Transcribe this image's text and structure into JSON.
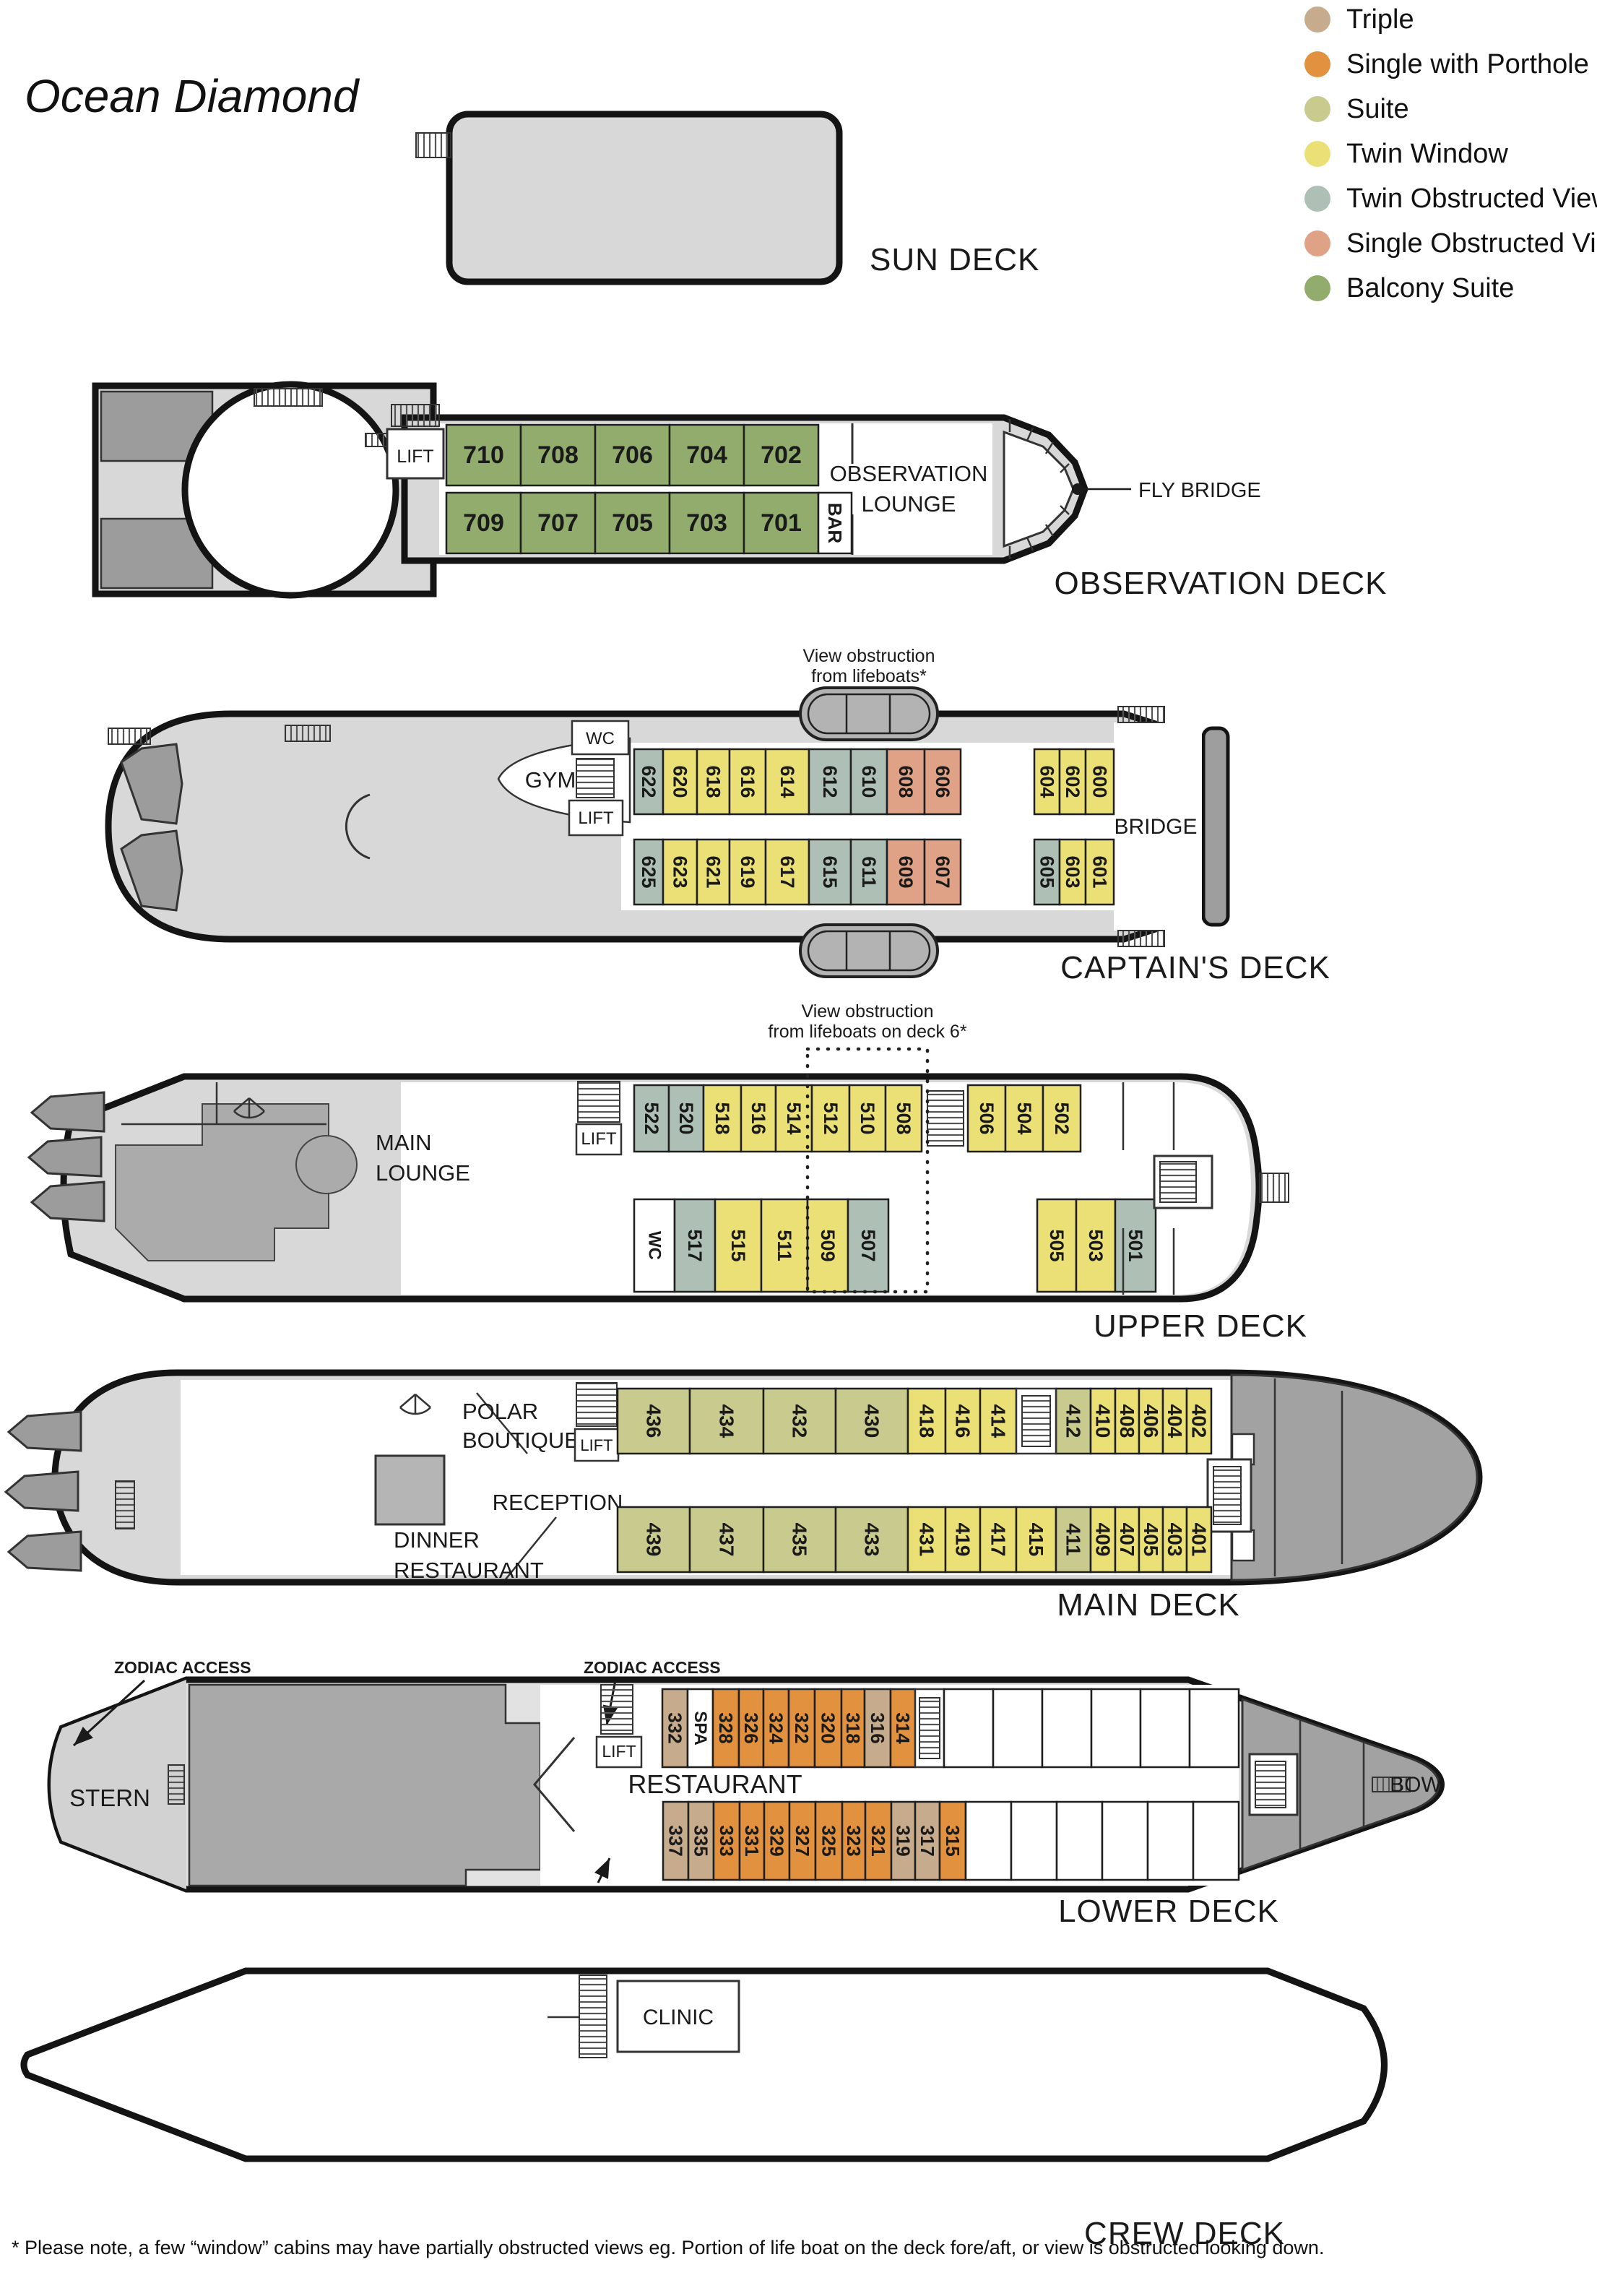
{
  "title": "Ocean Diamond",
  "colors": {
    "triple": "#c6ab8c",
    "single_porthole": "#e2913e",
    "suite": "#c9cb8e",
    "twin_window": "#ebe076",
    "twin_obstructed": "#aec0b6",
    "single_obstructed": "#dfa287",
    "balcony_suite": "#92ac6d",
    "room": "#ffffff"
  },
  "legend": [
    {
      "label": "Triple",
      "type": "triple"
    },
    {
      "label": "Single with Porthole",
      "type": "single_porthole"
    },
    {
      "label": "Suite",
      "type": "suite"
    },
    {
      "label": "Twin Window",
      "type": "twin_window"
    },
    {
      "label": "Twin Obstructed View",
      "type": "twin_obstructed"
    },
    {
      "label": "Single Obstructed View",
      "type": "single_obstructed"
    },
    {
      "label": "Balcony Suite",
      "type": "balcony_suite"
    }
  ],
  "labels": {
    "lift": "LIFT",
    "wc": "WC",
    "gym": "GYM",
    "bridge": "BRIDGE",
    "stern": "STERN",
    "bow": "BOW",
    "restaurant": "RESTAURANT",
    "clinic": "CLINIC",
    "reception": "RECEPTION",
    "fly_bridge": "FLY BRIDGE",
    "zodiac_access": "ZODIAC ACCESS",
    "polar_line1": "POLAR",
    "polar_line2": "BOUTIQUE",
    "dinner_line1": "DINNER",
    "dinner_line2": "RESTAURANT",
    "main_lounge_line1": "MAIN",
    "main_lounge_line2": "LOUNGE",
    "obs_lounge_line1": "OBSERVATION",
    "obs_lounge_line2": "LOUNGE"
  },
  "decks": {
    "sun": {
      "name": "SUN DECK"
    },
    "observation": {
      "name": "OBSERVATION DECK",
      "cabins_top": [
        {
          "n": "710",
          "t": "balcony_suite"
        },
        {
          "n": "708",
          "t": "balcony_suite"
        },
        {
          "n": "706",
          "t": "balcony_suite"
        },
        {
          "n": "704",
          "t": "balcony_suite"
        },
        {
          "n": "702",
          "t": "balcony_suite"
        }
      ],
      "cabins_bottom": [
        {
          "n": "709",
          "t": "balcony_suite"
        },
        {
          "n": "707",
          "t": "balcony_suite"
        },
        {
          "n": "705",
          "t": "balcony_suite"
        },
        {
          "n": "703",
          "t": "balcony_suite"
        },
        {
          "n": "701",
          "t": "balcony_suite"
        },
        {
          "n": "BAR",
          "t": "room"
        }
      ]
    },
    "captains": {
      "name": "CAPTAIN'S DECK",
      "note_line1": "View obstruction",
      "note_line2": "from lifeboats*",
      "cabins_top": [
        {
          "n": "622",
          "t": "twin_obstructed"
        },
        {
          "n": "620",
          "t": "twin_window"
        },
        {
          "n": "618",
          "t": "twin_window"
        },
        {
          "n": "616",
          "t": "twin_window"
        },
        {
          "n": "614",
          "t": "twin_window"
        },
        {
          "n": "612",
          "t": "twin_obstructed"
        },
        {
          "n": "610",
          "t": "twin_obstructed"
        },
        {
          "n": "608",
          "t": "single_obstructed"
        },
        {
          "n": "606",
          "t": "single_obstructed"
        },
        {
          "n": "604",
          "t": "twin_window"
        },
        {
          "n": "602",
          "t": "twin_window"
        },
        {
          "n": "600",
          "t": "twin_window"
        }
      ],
      "cabins_bottom": [
        {
          "n": "625",
          "t": "twin_obstructed"
        },
        {
          "n": "623",
          "t": "twin_window"
        },
        {
          "n": "621",
          "t": "twin_window"
        },
        {
          "n": "619",
          "t": "twin_window"
        },
        {
          "n": "617",
          "t": "twin_window"
        },
        {
          "n": "615",
          "t": "twin_obstructed"
        },
        {
          "n": "611",
          "t": "twin_obstructed"
        },
        {
          "n": "609",
          "t": "single_obstructed"
        },
        {
          "n": "607",
          "t": "single_obstructed"
        },
        {
          "n": "605",
          "t": "twin_obstructed"
        },
        {
          "n": "603",
          "t": "twin_window"
        },
        {
          "n": "601",
          "t": "twin_window"
        }
      ]
    },
    "upper": {
      "name": "UPPER DECK",
      "note_line1": "View obstruction",
      "note_line2": "from lifeboats on deck 6*",
      "cabins_top": [
        {
          "n": "522",
          "t": "twin_obstructed"
        },
        {
          "n": "520",
          "t": "twin_obstructed"
        },
        {
          "n": "518",
          "t": "twin_window"
        },
        {
          "n": "516",
          "t": "twin_window"
        },
        {
          "n": "514",
          "t": "twin_window"
        },
        {
          "n": "512",
          "t": "twin_window"
        },
        {
          "n": "510",
          "t": "twin_window"
        },
        {
          "n": "508",
          "t": "twin_window"
        },
        {
          "n": "506",
          "t": "twin_window"
        },
        {
          "n": "504",
          "t": "twin_window"
        },
        {
          "n": "502",
          "t": "twin_window"
        }
      ],
      "cabins_bottom": [
        {
          "n": "WC",
          "t": "room"
        },
        {
          "n": "517",
          "t": "twin_obstructed"
        },
        {
          "n": "515",
          "t": "twin_window"
        },
        {
          "n": "511",
          "t": "twin_window"
        },
        {
          "n": "509",
          "t": "twin_window"
        },
        {
          "n": "507",
          "t": "twin_obstructed"
        },
        {
          "n": "505",
          "t": "twin_window"
        },
        {
          "n": "503",
          "t": "twin_window"
        },
        {
          "n": "501",
          "t": "twin_obstructed"
        }
      ]
    },
    "main": {
      "name": "MAIN DECK",
      "cabins_top": [
        {
          "n": "436",
          "t": "suite"
        },
        {
          "n": "434",
          "t": "suite"
        },
        {
          "n": "432",
          "t": "suite"
        },
        {
          "n": "430",
          "t": "suite"
        },
        {
          "n": "418",
          "t": "twin_window"
        },
        {
          "n": "416",
          "t": "twin_window"
        },
        {
          "n": "414",
          "t": "twin_window"
        },
        {
          "n": "412",
          "t": "suite"
        },
        {
          "n": "410",
          "t": "twin_window"
        },
        {
          "n": "408",
          "t": "twin_window"
        },
        {
          "n": "406",
          "t": "twin_window"
        },
        {
          "n": "404",
          "t": "twin_window"
        },
        {
          "n": "402",
          "t": "twin_window"
        }
      ],
      "cabins_bottom": [
        {
          "n": "439",
          "t": "suite"
        },
        {
          "n": "437",
          "t": "suite"
        },
        {
          "n": "435",
          "t": "suite"
        },
        {
          "n": "433",
          "t": "suite"
        },
        {
          "n": "431",
          "t": "twin_window"
        },
        {
          "n": "419",
          "t": "twin_window"
        },
        {
          "n": "417",
          "t": "twin_window"
        },
        {
          "n": "415",
          "t": "twin_window"
        },
        {
          "n": "411",
          "t": "suite"
        },
        {
          "n": "409",
          "t": "twin_window"
        },
        {
          "n": "407",
          "t": "twin_window"
        },
        {
          "n": "405",
          "t": "twin_window"
        },
        {
          "n": "403",
          "t": "twin_window"
        },
        {
          "n": "401",
          "t": "twin_window"
        }
      ]
    },
    "lower": {
      "name": "LOWER DECK",
      "cabins_top": [
        {
          "n": "332",
          "t": "triple"
        },
        {
          "n": "SPA",
          "t": "room"
        },
        {
          "n": "328",
          "t": "single_porthole"
        },
        {
          "n": "326",
          "t": "single_porthole"
        },
        {
          "n": "324",
          "t": "single_porthole"
        },
        {
          "n": "322",
          "t": "single_porthole"
        },
        {
          "n": "320",
          "t": "single_porthole"
        },
        {
          "n": "318",
          "t": "single_porthole"
        },
        {
          "n": "316",
          "t": "triple"
        },
        {
          "n": "314",
          "t": "single_porthole"
        }
      ],
      "cabins_bottom": [
        {
          "n": "337",
          "t": "triple"
        },
        {
          "n": "335",
          "t": "triple"
        },
        {
          "n": "333",
          "t": "single_porthole"
        },
        {
          "n": "331",
          "t": "single_porthole"
        },
        {
          "n": "329",
          "t": "single_porthole"
        },
        {
          "n": "327",
          "t": "single_porthole"
        },
        {
          "n": "325",
          "t": "single_porthole"
        },
        {
          "n": "323",
          "t": "single_porthole"
        },
        {
          "n": "321",
          "t": "single_porthole"
        },
        {
          "n": "319",
          "t": "triple"
        },
        {
          "n": "317",
          "t": "triple"
        },
        {
          "n": "315",
          "t": "single_porthole"
        }
      ]
    },
    "crew": {
      "name": "CREW DECK"
    }
  },
  "footnote": "* Please note, a few “window” cabins may have partially obstructed views eg. Portion of life boat on the deck fore/aft, or view is obstructed looking down."
}
